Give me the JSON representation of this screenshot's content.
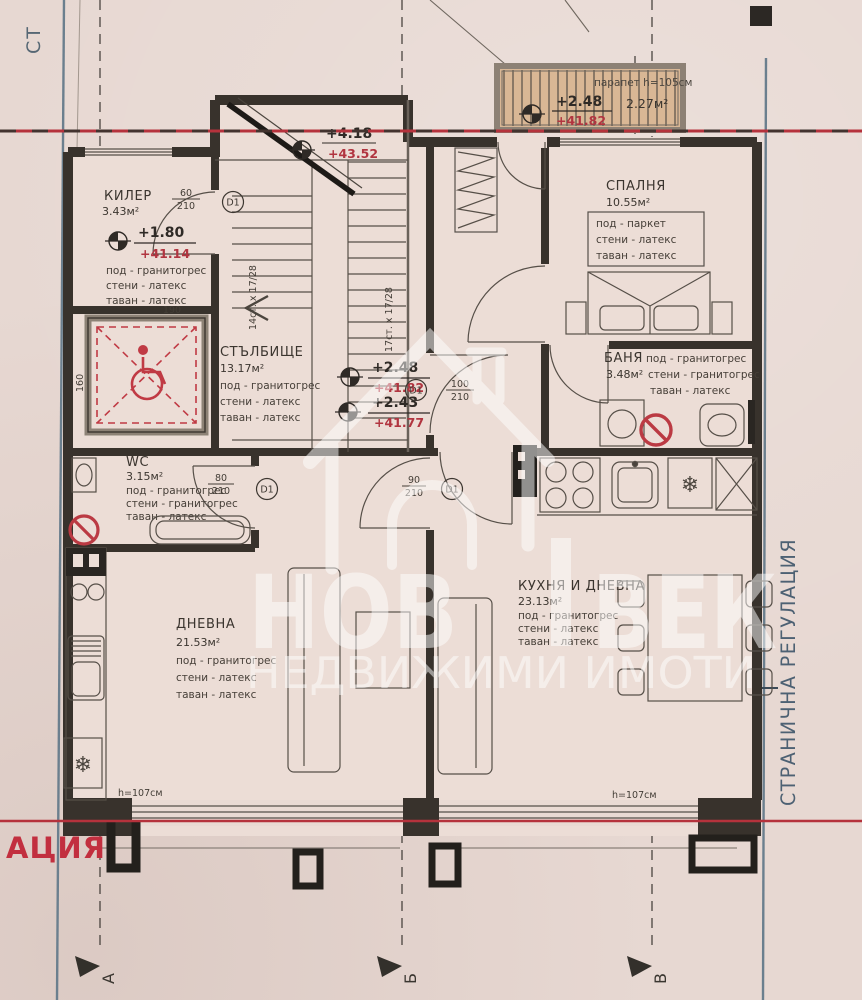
{
  "site": {
    "label_top_left": "СТ",
    "label_right": "СТРАНИЧНА РЕГУЛАЦИЯ",
    "label_bottom_left": "АЦИЯ",
    "axes": {
      "a": "А",
      "b": "Б",
      "v": "В"
    }
  },
  "terrace": {
    "note": "парапет h=105см",
    "area": "2.27м²",
    "elev_rel": "+2.48",
    "elev_abs": "+41.82"
  },
  "rooms": {
    "kiler": {
      "name": "КИЛЕР",
      "area": "3.43м²",
      "elev_rel": "+1.80",
      "elev_abs": "+41.14",
      "f1": "под - гранитогрес",
      "f2": "стени - латекс",
      "f3": "таван - латекс"
    },
    "spalnya": {
      "name": "СПАЛНЯ",
      "area": "10.55м²",
      "f1": "под - паркет",
      "f2": "стени - латекс",
      "f3": "таван - латекс"
    },
    "stalbishte": {
      "name": "СТЪЛБИЩЕ",
      "area": "13.17м²",
      "f1": "под - гранитогрес",
      "f2": "стени - латекс",
      "f3": "таван - латекс"
    },
    "banya": {
      "name": "БАНЯ",
      "area": "3.48м²",
      "f1": "под - гранитогрес",
      "f2": "стени - гранитогрес",
      "f3": "таван - латекс"
    },
    "wc": {
      "name": "WC",
      "area": "3.15м²",
      "f1": "под - гранитогрес",
      "f2": "стени - гранитогрес",
      "f3": "таван - латекс"
    },
    "dnevna": {
      "name": "ДНЕВНА",
      "area": "21.53м²",
      "f1": "под - гранитогрес",
      "f2": "стени - латекс",
      "f3": "таван - латекс"
    },
    "kuhnya": {
      "name": "КУХНЯ И ДНЕВНА",
      "area": "23.13м²",
      "f1": "под - гранитогрес",
      "f2": "стени - латекс",
      "f3": "таван - латекс"
    }
  },
  "stairs": {
    "flight_left": "14ст. х 17/28",
    "flight_right": "17ст. х 17/28",
    "elev_top_rel": "+4.18",
    "elev_top_abs": "+43.52",
    "elev_mid_rel": "+2.48",
    "elev_mid_abs": "+41.82",
    "elev_low_rel": "+2.43",
    "elev_low_abs": "+41.77"
  },
  "doors": {
    "code": "D1",
    "kiler_w": "60",
    "kiler_h": "210",
    "wc_w": "80",
    "wc_h": "210",
    "entry_w": "100",
    "entry_h": "210",
    "kitchen_w": "90",
    "kitchen_h": "210"
  },
  "windows": {
    "sill_left": "h=107см",
    "sill_right": "h=107см"
  },
  "platform": {
    "dim_top": "190",
    "dim_left": "160"
  },
  "icons": {
    "fridge": "❄"
  },
  "watermark": {
    "word1": "НОВ",
    "word2": "ВЕК",
    "subtitle": "НЕДВИЖИМИ ИМОТИ"
  },
  "colors": {
    "regulation_red": "#b5323c",
    "boundary_blue": "#5d7485",
    "wall": "#38322c",
    "paper": "#e7d8d2"
  }
}
